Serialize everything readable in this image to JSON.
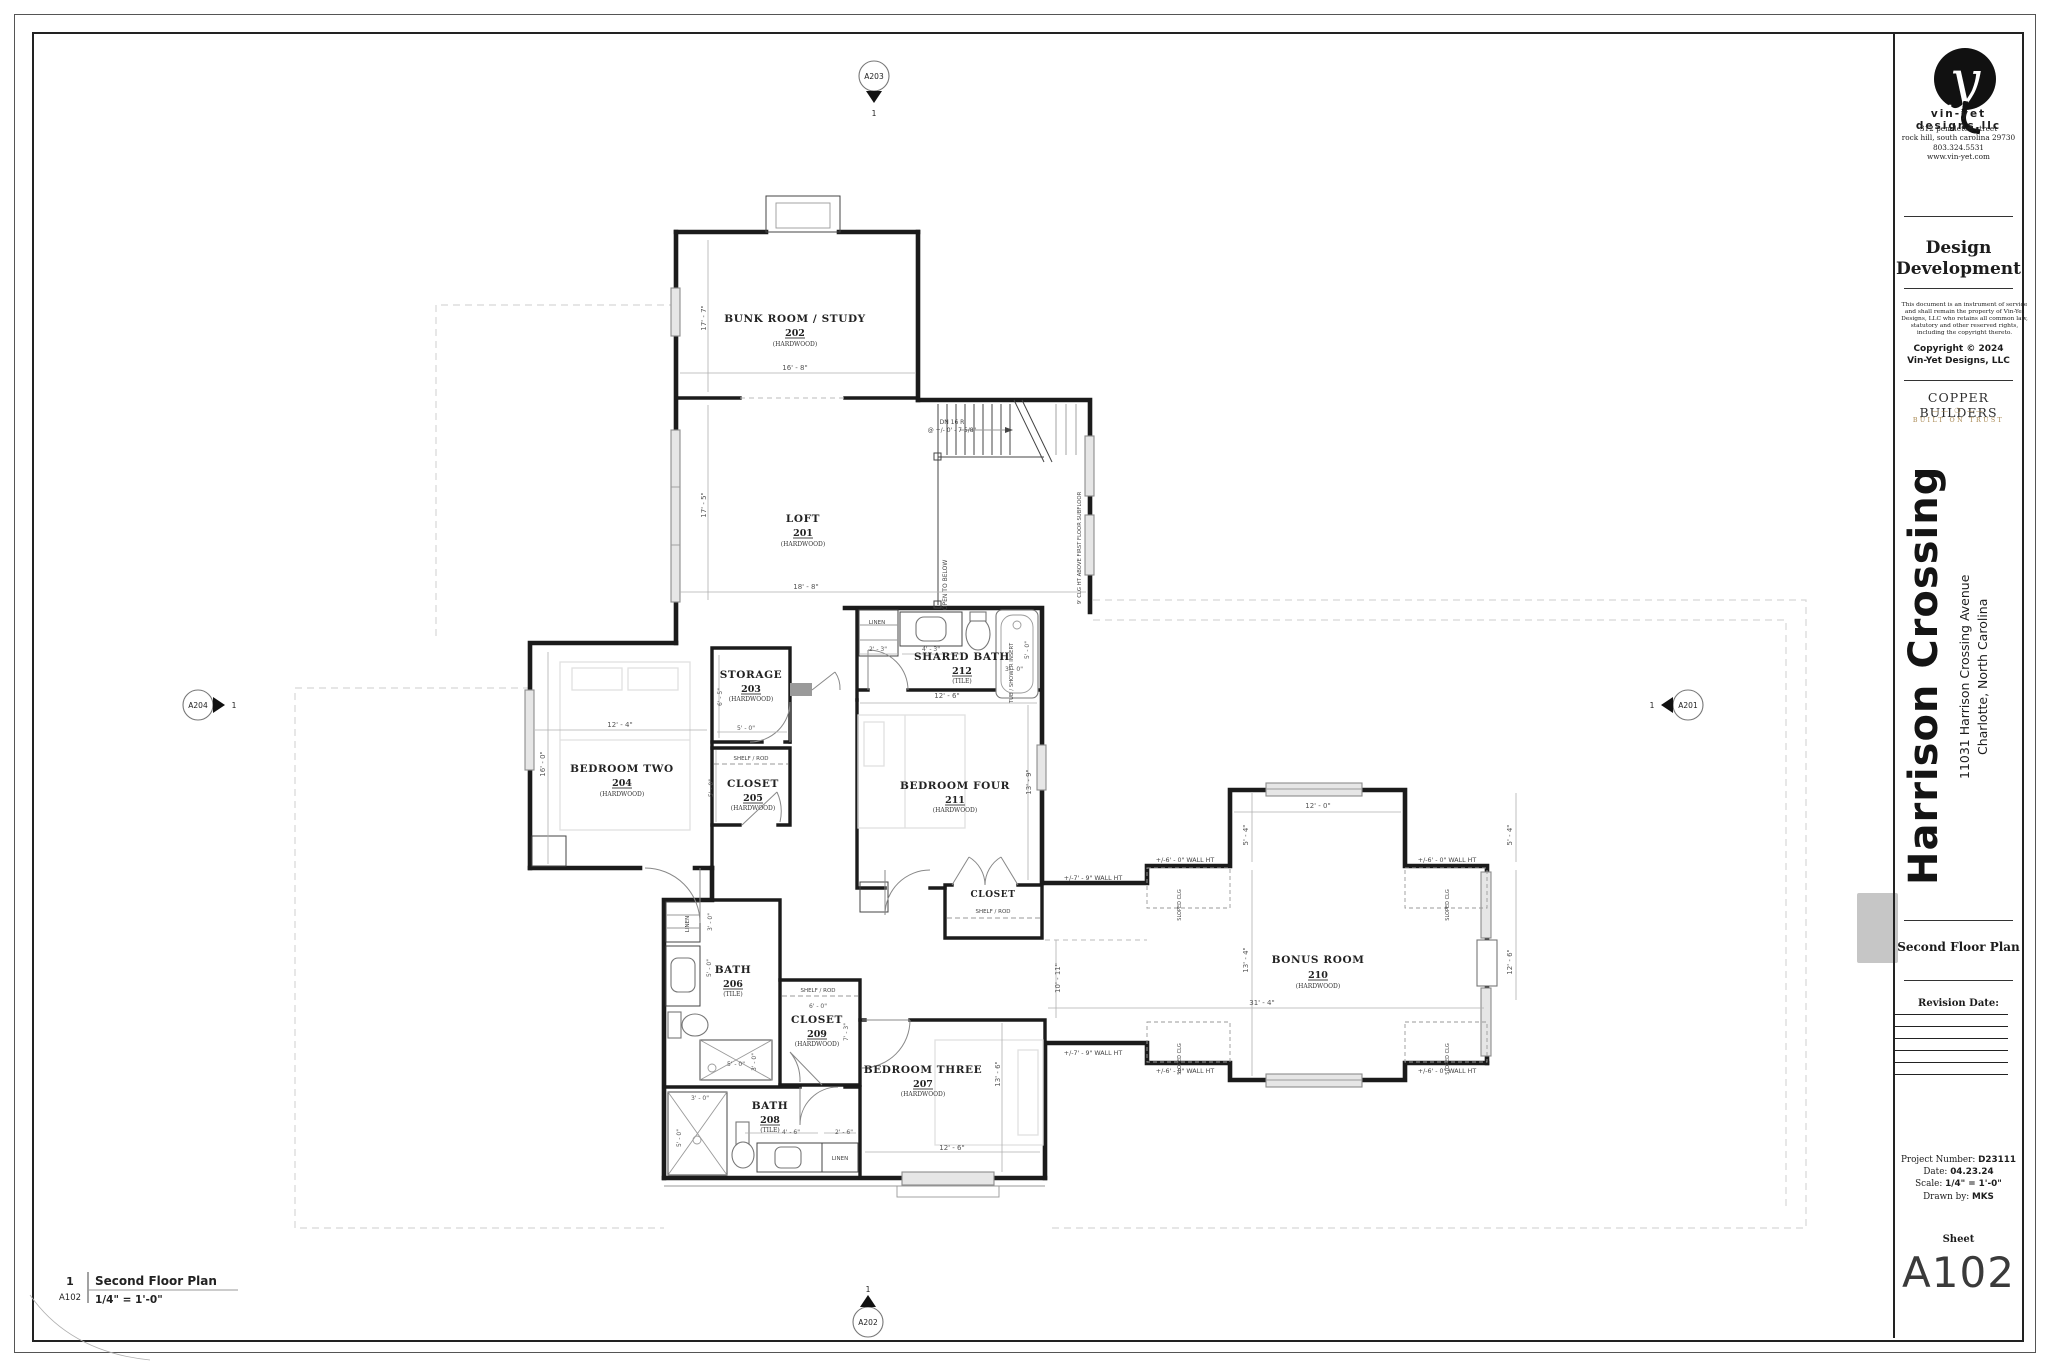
{
  "titleblock": {
    "firm": {
      "logo_letter": "y",
      "name": "vin-yet designs,llc",
      "address1": "312 pendleton street",
      "address2": "rock hill, south carolina 29730",
      "phone": "803.324.5531",
      "web": "www.vin-yet.com"
    },
    "phase_line1": "Design",
    "phase_line2": "Development",
    "disclaimer": "This document is an instrument of service and shall remain the property of Vin-Yet Designs, LLC who retains all common law, statutory and other reserved rights, including the copyright thereto.",
    "copyright_line1": "Copyright © 2024",
    "copyright_line2": "Vin-Yet Designs, LLC",
    "builder": {
      "name": "COPPER BUILDERS",
      "motif": "—— ❍ ——",
      "tagline": "BUILT ON TRUST",
      "accent": "#a8874f"
    },
    "project": {
      "title": "Harrison Crossing",
      "address_line1": "11031 Harrison Crossing Avenue",
      "address_line2": "Charlotte, North Carolina"
    },
    "sheet_title": "Second Floor Plan",
    "revision_label": "Revision Date:",
    "info": {
      "project_number_label": "Project Number:",
      "project_number": "D23111",
      "date_label": "Date:",
      "date": "04.23.24",
      "scale_label": "Scale:",
      "scale": "1/4\" = 1'-0\"",
      "drawn_label": "Drawn by:",
      "drawn": "MKS"
    },
    "sheet_label": "Sheet",
    "sheet_number": "A102"
  },
  "viewport": {
    "number": "1",
    "sheet": "A102",
    "title": "Second Floor Plan",
    "scale": "1/4\" = 1'-0\""
  },
  "markers": [
    {
      "id": "A203",
      "num": "1"
    },
    {
      "id": "A204",
      "num": "1"
    },
    {
      "id": "A201",
      "num": "1"
    },
    {
      "id": "A202",
      "num": "1"
    }
  ],
  "plan": {
    "rooms": [
      {
        "name": "BUNK ROOM / STUDY",
        "number": "202",
        "finish": "(HARDWOOD)"
      },
      {
        "name": "LOFT",
        "number": "201",
        "finish": "(HARDWOOD)"
      },
      {
        "name": "STORAGE",
        "number": "203",
        "finish": "(HARDWOOD)"
      },
      {
        "name": "BEDROOM TWO",
        "number": "204",
        "finish": "(HARDWOOD)"
      },
      {
        "name": "CLOSET",
        "number": "205",
        "finish": "(HARDWOOD)"
      },
      {
        "name": "BATH",
        "number": "206",
        "finish": "(TILE)"
      },
      {
        "name": "BEDROOM THREE",
        "number": "207",
        "finish": "(HARDWOOD)"
      },
      {
        "name": "BATH",
        "number": "208",
        "finish": "(TILE)"
      },
      {
        "name": "CLOSET",
        "number": "209",
        "finish": "(HARDWOOD)"
      },
      {
        "name": "BONUS ROOM",
        "number": "210",
        "finish": "(HARDWOOD)"
      },
      {
        "name": "BEDROOM FOUR",
        "number": "211",
        "finish": "(HARDWOOD)"
      },
      {
        "name": "SHARED BATH",
        "number": "212",
        "finish": "(TILE)"
      },
      {
        "name": "CLOSET",
        "number": "",
        "finish": ""
      }
    ],
    "notes": {
      "dn1": "DN 16 R",
      "dn2": "@ +/- 0' - 7 5/8\"",
      "open_below": "OPEN TO BELOW",
      "clg": "9' CLG HT ABOVE FIRST FLOOR SUBFLOOR",
      "linen": "LINEN",
      "shelf_rod": "SHELF / ROD",
      "tub": "TUB / SHOWER INSERT",
      "sloped": "SLOPED CLG",
      "wh79": "+/-7' - 9\" WALL HT",
      "wh60": "+/-6' - 0\" WALL HT"
    },
    "dims": [
      "17' - 7\"",
      "16' - 8\"",
      "17' - 5\"",
      "18' - 8\"",
      "2' - 3\"",
      "4' - 3\"",
      "5' - 0\"",
      "3' - 0\"",
      "12' - 6\"",
      "13' - 9\"",
      "12' - 4\"",
      "16' - 0\"",
      "6' - 5\"",
      "5' - 0\"",
      "5' - 0\"",
      "3' - 0\"",
      "5' - 0\"",
      "5' - 0\"",
      "3' - 0\"",
      "6' - 0\"",
      "7' - 3\"",
      "3' - 0\"",
      "5' - 0\"",
      "4' - 6\"",
      "2' - 6\"",
      "13' - 6\"",
      "12' - 6\"",
      "12' - 0\"",
      "5' - 4\"",
      "13' - 4\"",
      "31' - 4\"",
      "10' - 11\"",
      "5' - 4\"",
      "12' - 6\""
    ]
  }
}
